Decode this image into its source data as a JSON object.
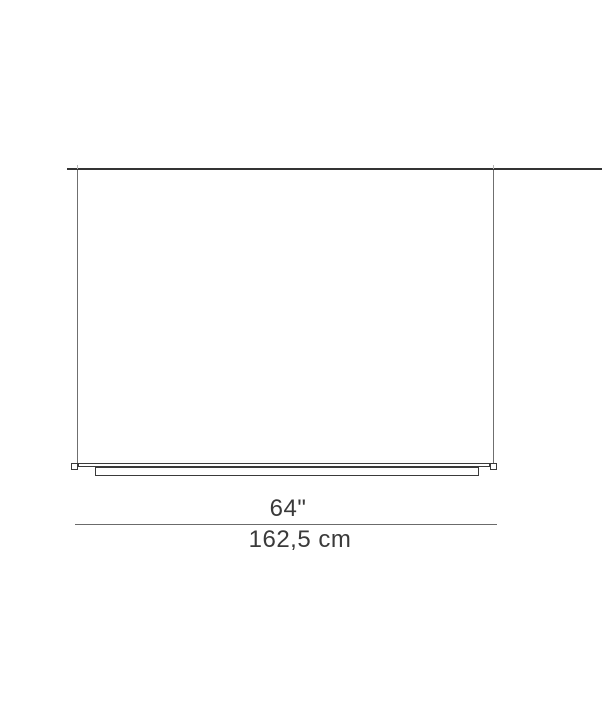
{
  "diagram": {
    "type": "product-dimension-drawing",
    "subject": "linear suspension lamp, front elevation",
    "dimension": {
      "inches_label": "64\"",
      "cm_label": "162,5 cm"
    },
    "colors": {
      "background": "#ffffff",
      "outline": "#3a3a3a",
      "ceiling_line": "#343434",
      "cable": "#6f6f6f",
      "dimension_line": "#6b6b6b",
      "text": "#3a3a3a"
    }
  }
}
